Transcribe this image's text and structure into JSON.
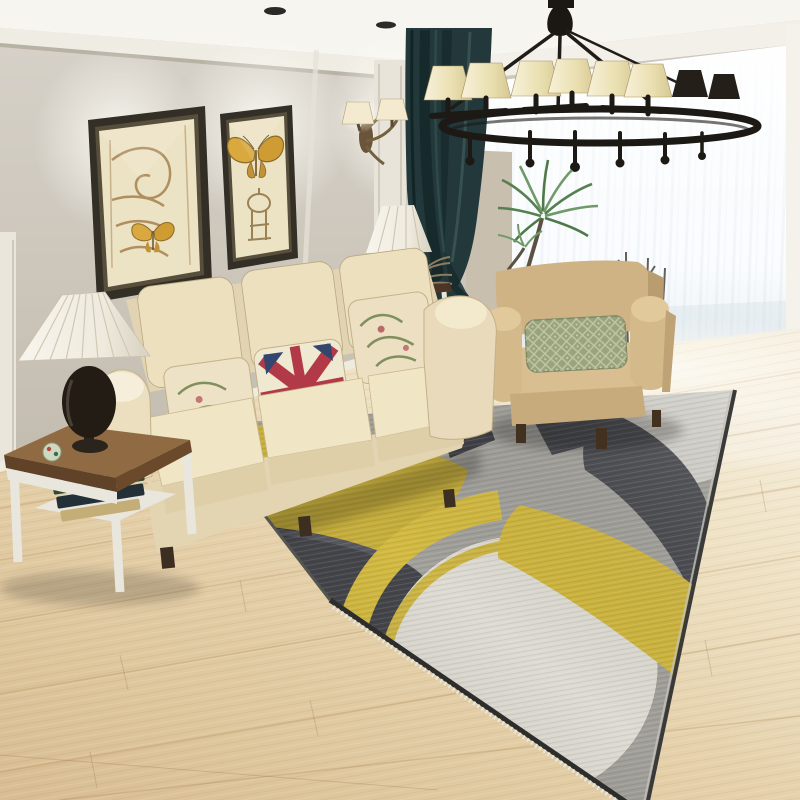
{
  "scene": {
    "kind": "photograph",
    "subject": "Modern living room with yellow-gray geometric circle rug",
    "aria_label": "Living room photo: cream three-seat sofa with floral and Union Jack pillows, beige armchair with green diamond pillow, black wrought-iron chandelier with six cream shades, two framed sepia butterfly prints, bronze wall sconce, dark teal curtain beside a bright sheer-curtained window, palm plant, white side table with pleated-shade lamp and books, light oak wood floor, and a large gray area rug patterned with overlapping yellow, charcoal and cream circles",
    "objects": [
      "ceiling-spotlights",
      "crown-molding",
      "wall-panels",
      "framed-print-architectural-butterfly",
      "framed-print-butterfly-tower",
      "wall-sconce",
      "teal-curtain",
      "sheer-window",
      "chandelier",
      "palm-plant",
      "dried-branches",
      "console-table",
      "console-lamp",
      "sofa",
      "floral-pillow-left",
      "union-jack-pillow",
      "floral-pillow-right",
      "armchair",
      "green-diamond-pillow",
      "side-table",
      "pleated-table-lamp",
      "books",
      "decor-ball",
      "wood-floor",
      "geometric-rug"
    ],
    "palette": {
      "ceiling": "#f7f5ef",
      "wall": "#cdc7bc",
      "wall_dark": "#c0b9ab",
      "trim_white": "#eae6dc",
      "curtain_teal": "#22383a",
      "curtain_teal_dark": "#15282a",
      "sheer": "#f5f9fb",
      "chandelier_iron": "#1d1915",
      "lamp_shade_cream": "#eadfb0",
      "frame_dark": "#332f27",
      "print_paper": "#ece2c4",
      "butterfly_yellow": "#d9a93f",
      "sofa_cream": "#e9dcbd",
      "sofa_highlight": "#f6eeda",
      "pillow_floral_base": "#eee2c6",
      "union_jack_red": "#b23a47",
      "union_jack_blue": "#35466e",
      "armchair_tan": "#cfb384",
      "pillow_green": "#99a37d",
      "table_wood_top": "#7d5a38",
      "table_white": "#e9e6dd",
      "floor_wood": "#dfc9a2",
      "floor_bright": "#f3ead7",
      "rug_base_gray": "#a2a09a",
      "rug_yellow": "#d3ba41",
      "rug_charcoal": "#46474c",
      "rug_light_gray": "#c6c4bd",
      "rug_cream": "#dddbd2",
      "rug_fringe": "#2d2d2b"
    }
  }
}
